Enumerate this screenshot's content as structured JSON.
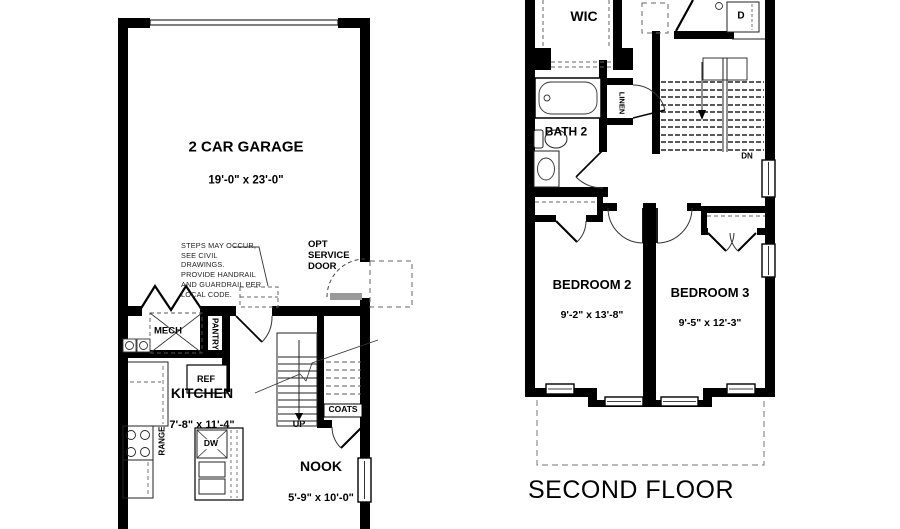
{
  "meta": {
    "bg_color": "#ffffff",
    "wall_color": "#000000",
    "line_color": "#1a1a1a",
    "dash_color": "#666666"
  },
  "first_floor": {
    "garage": {
      "name": "2 CAR GARAGE",
      "dims": "19'-0\" x 23'-0\""
    },
    "note": "STEPS MAY OCCUR,\nSEE CIVIL DRAWINGS.\nPROVIDE HANDRAIL\nAND GUARDRAIL PER\nLOCAL CODE.",
    "service_door": "OPT\nSERVICE\nDOOR",
    "mech": "MECH",
    "pantry": "PANTRY",
    "ref": "REF",
    "kitchen": {
      "name": "KITCHEN",
      "dims": "7'-8\" x 11'-4\""
    },
    "range": "RANGE",
    "dw": "DW",
    "up": "UP",
    "coats": "COATS",
    "nook": {
      "name": "NOOK",
      "dims": "5'-9\" x 10'-0\""
    }
  },
  "second_floor": {
    "title": "SECOND FLOOR",
    "wic": "WIC",
    "bath": "BATH 2",
    "linen": "LINEN",
    "dryer": "D",
    "dn": "DN",
    "bedroom2": {
      "name": "BEDROOM 2",
      "dims": "9'-2\" x 13'-8\""
    },
    "bedroom3": {
      "name": "BEDROOM 3",
      "dims": "9'-5\" x 12'-3\""
    }
  }
}
